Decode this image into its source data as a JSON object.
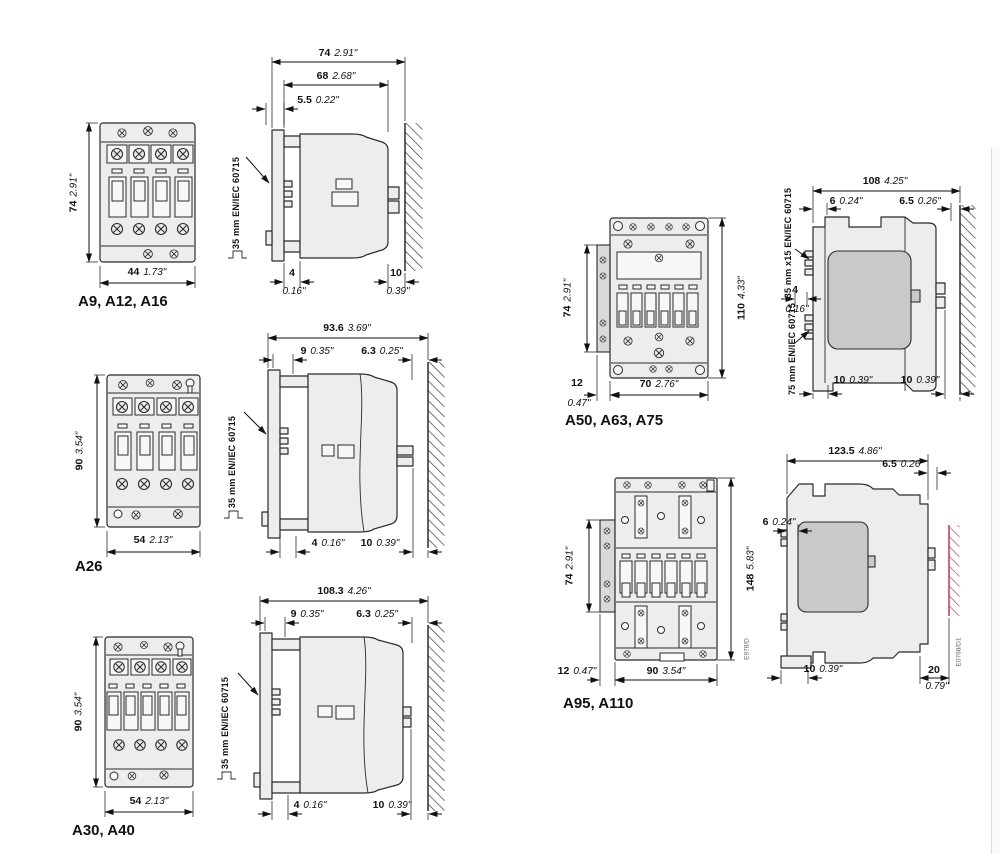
{
  "page": {
    "background": "#ffffff",
    "line_color": "#2b2b2b",
    "dim_color": "#111111",
    "red_hatch_color": "#b24a5e"
  },
  "a9": {
    "title": "A9, A12, A16",
    "front_h_mm": "74",
    "front_h_in": "2.91\"",
    "front_w_mm": "44",
    "front_w_in": "1.73\"",
    "side_total_mm": "74",
    "side_total_in": "2.91\"",
    "side_body_mm": "68",
    "side_body_in": "2.68\"",
    "side_front_mm": "5.5",
    "side_front_in": "0.22\"",
    "rail_label": "35 mm EN/IEC 60715",
    "gap_front_mm": "4",
    "gap_front_in": "0.16\"",
    "gap_wall_mm": "10",
    "gap_wall_in": "0.39\""
  },
  "a26": {
    "title": "A26",
    "front_h_mm": "90",
    "front_h_in": "3.54\"",
    "front_w_mm": "54",
    "front_w_in": "2.13\"",
    "side_total_mm": "93.6",
    "side_total_in": "3.69\"",
    "d1_mm": "9",
    "d1_in": "0.35\"",
    "d2_mm": "6.3",
    "d2_in": "0.25\"",
    "rail_label": "35 mm EN/IEC 60715",
    "gap_front_mm": "4",
    "gap_front_in": "0.16\"",
    "gap_wall_mm": "10",
    "gap_wall_in": "0.39\""
  },
  "a30": {
    "title": "A30, A40",
    "front_h_mm": "90",
    "front_h_in": "3.54\"",
    "front_w_mm": "54",
    "front_w_in": "2.13\"",
    "side_total_mm": "108.3",
    "side_total_in": "4.26\"",
    "d1_mm": "9",
    "d1_in": "0.35\"",
    "d2_mm": "6.3",
    "d2_in": "0.25\"",
    "rail_label": "35 mm EN/IEC 60715",
    "gap_front_mm": "4",
    "gap_front_in": "0.16\"",
    "gap_wall_mm": "10",
    "gap_wall_in": "0.39\""
  },
  "a50": {
    "title": "A50, A63, A75",
    "strip_h_mm": "74",
    "strip_h_in": "2.91\"",
    "front_h_mm": "110",
    "front_h_in": "4.33\"",
    "strip_w_mm": "12",
    "strip_w_in": "0.47\"",
    "front_w_mm": "70",
    "front_w_in": "2.76\"",
    "side_total_mm": "108",
    "side_total_in": "4.25\"",
    "d1_mm": "6",
    "d1_in": "0.24\"",
    "d2_mm": "6.5",
    "d2_in": "0.26\"",
    "rail_top": "35 mm x15 EN/IEC 60715",
    "rail_bottom": "75 mm EN/IEC 60715",
    "mid_mm": "4",
    "mid_in": "0.16\"",
    "gap1_mm": "10",
    "gap1_in": "0.39\"",
    "gap2_mm": "10",
    "gap2_in": "0.39\""
  },
  "a95": {
    "title": "A95, A110",
    "strip_h_mm": "74",
    "strip_h_in": "2.91\"",
    "front_h_mm": "148",
    "front_h_in": "5.83\"",
    "strip_w_mm": "12",
    "strip_w_in": "0.47\"",
    "front_w_mm": "90",
    "front_w_in": "3.54\"",
    "front_code": "E978/D",
    "side_total_mm": "123.5",
    "side_total_in": "4.86\"",
    "d_top_mm": "6.5",
    "d_top_in": "0.26\"",
    "d_front_mm": "6",
    "d_front_in": "0.24\"",
    "gap_floor_mm": "10",
    "gap_floor_in": "0.39\"",
    "gap_wall_mm": "20",
    "gap_wall_in": "0.79\"",
    "side_code": "E0768/D1"
  }
}
